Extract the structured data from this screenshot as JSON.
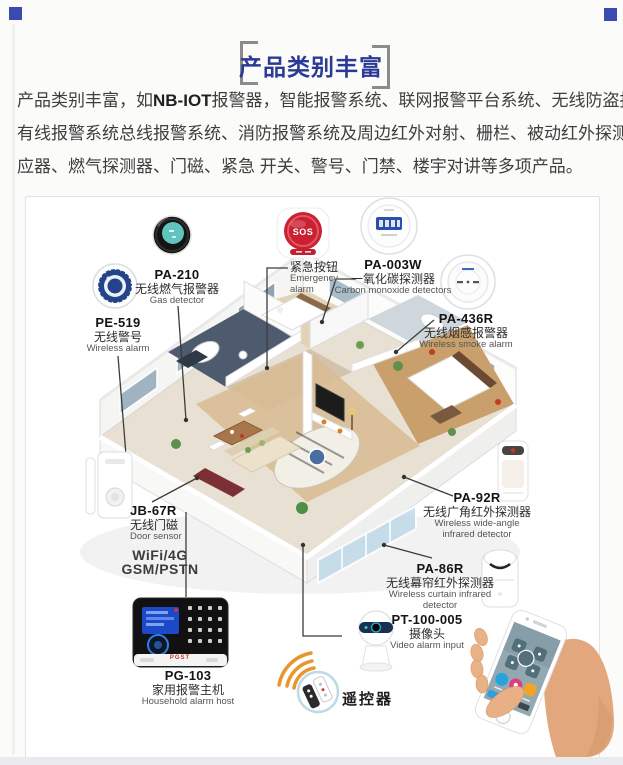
{
  "header": {
    "title": "产品类别丰富"
  },
  "intro": {
    "line1_pre": "产品类别丰富，如",
    "line1_bold": "NB-IOT",
    "line1_post": "报警器，智能报警系统、联网报警平台系统、无线防盗报警系统、",
    "line2": "有线报警系统总线报警系统、消防报警系统及周边红外对射、栅栏、被动红外探测器、烟雾感",
    "line3": "应器、燃气探测器、门磁、紧急 开关、警号、门禁、楼宇对讲等多项产品。"
  },
  "devices": {
    "pa210": {
      "model": "PA-210",
      "cn": "无线燃气报警器",
      "en": "Gas detector"
    },
    "pe519": {
      "model": "PE-519",
      "cn": "无线警号",
      "en": "Wireless alarm"
    },
    "sos": {
      "cn": "紧急按钮",
      "en1": "Emergency",
      "en2": "alarm",
      "button_text": "SOS"
    },
    "pa003w": {
      "model": "PA-003W",
      "cn": "一氧化碳探测器",
      "en": "Carbon monoxide detectors"
    },
    "pa436r": {
      "model": "PA-436R",
      "cn": "无线烟感报警器",
      "en": "Wireless smoke alarm"
    },
    "jb67r": {
      "model": "JB-67R",
      "cn": "无线门磁",
      "en": "Door sensor"
    },
    "wifi": {
      "line1": "WiFi/4G",
      "line2": "GSM/PSTN"
    },
    "pa92r": {
      "model": "PA-92R",
      "cn": "无线广角红外探测器",
      "en1": "Wireless wide-angle",
      "en2": "infrared detector"
    },
    "pa86r": {
      "model": "PA-86R",
      "cn": "无线幕帘红外探测器",
      "en1": "Wireless curtain infrared",
      "en2": "detector"
    },
    "pt100": {
      "model": "PT-100-005",
      "cn": "摄像头",
      "en": "Video alarm input"
    },
    "pg103": {
      "model": "PG-103",
      "cn": "家用报警主机",
      "en": "Household alarm host",
      "logo": "PGST"
    },
    "remote": {
      "label": "遥控器"
    }
  },
  "colors": {
    "accent_blue": "#2b3a94",
    "square_blue": "#3a4ab0",
    "bracket_gray": "#8c8c8c",
    "sos_red": "#c92132",
    "siren_navy": "#24448a",
    "gas_teal": "#5ec4bd",
    "wifi_arc_orange": "#e8962e",
    "host_black": "#111111",
    "lcd_blue": "#2a4fae"
  }
}
